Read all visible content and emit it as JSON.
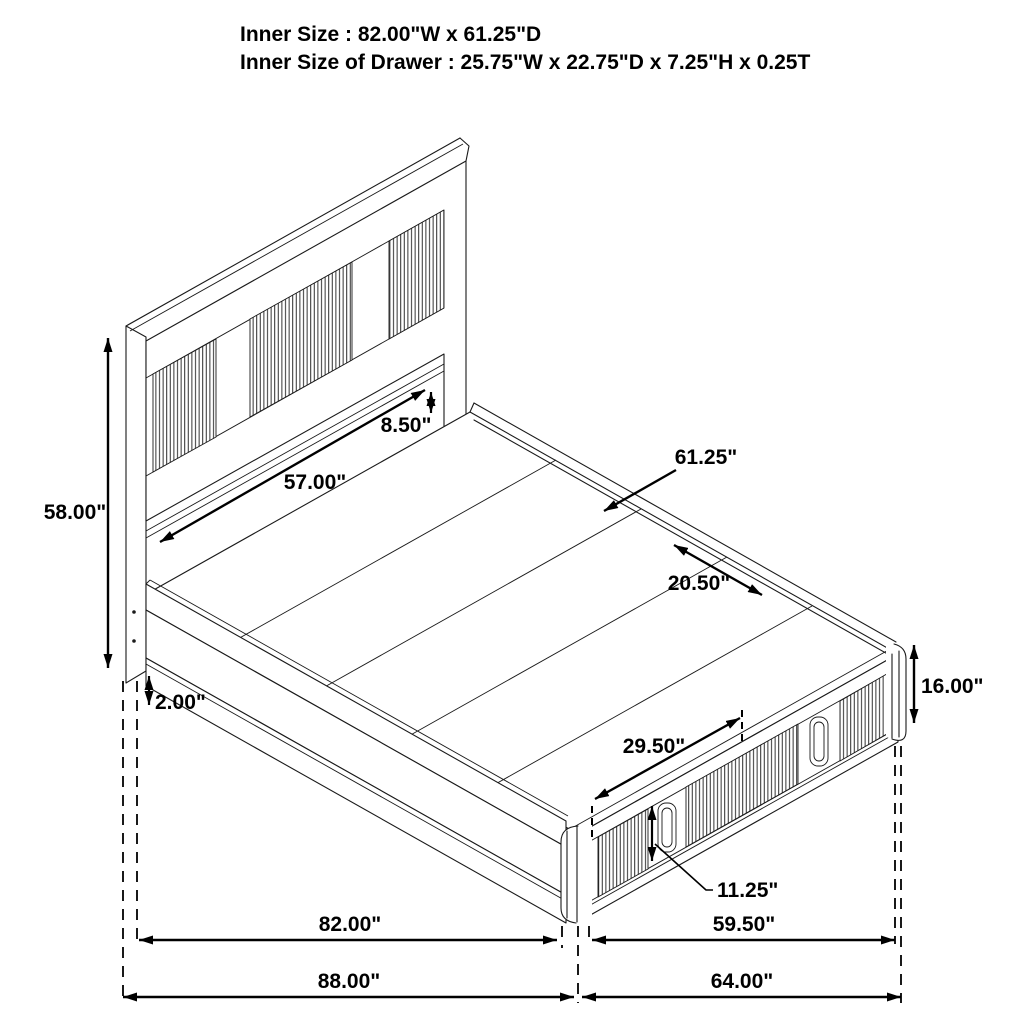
{
  "title": {
    "line1": "Inner Size : 82.00\"W x 61.25\"D",
    "line2": "Inner Size of Drawer : 25.75\"W x 22.75\"D x 7.25\"H x 0.25T"
  },
  "dimensions": {
    "headboard_height": "58.00\"",
    "headboard_panel_width": "57.00\"",
    "headboard_clearance": "8.50\"",
    "platform_depth": "61.25\"",
    "deck_inset": "20.50\"",
    "base_clearance": "2.00\"",
    "storage_height": "16.00\"",
    "drawer_width": "29.50\"",
    "drawer_front_height": "11.25\"",
    "platform_width": "82.00\"",
    "footboard_span": "59.50\"",
    "overall_width": "88.00\"",
    "overall_depth": "64.00\""
  },
  "colors": {
    "line": "#1a1a1a",
    "dimension": "#000000",
    "background": "#ffffff"
  }
}
